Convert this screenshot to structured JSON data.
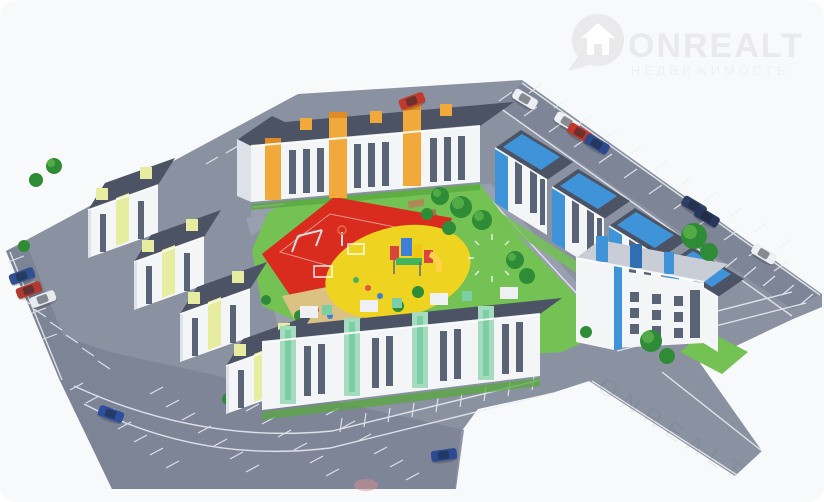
{
  "image": {
    "kind": "aerial-3d-render",
    "subject": "Residential quarter with courtyard playground, parking lots and landscaping"
  },
  "logo": {
    "brand": "ONREALT",
    "subtitle": "НЕДВИЖИМОСТЬ",
    "icon": "house-location-pin-icon",
    "color": "#eaeaec",
    "subtitle_color": "#f0f0f2"
  },
  "palette": {
    "page_bg": "#ffffff",
    "card_bg": "#f8f9fa",
    "ground": "#8a91a1",
    "parking": "#7a8295",
    "road_light": "#9aa1b0",
    "marking": "#eef0f4",
    "lawn": "#74c154",
    "lawn_dark": "#57a83e",
    "tree": "#2f8c36",
    "tree_light": "#5cb34c",
    "sport_red": "#d92c1e",
    "play_yellow": "#efd321",
    "sand": "#dcc184",
    "roof_dark": "#4c5365",
    "roof_light": "#c9ced6",
    "wall_white": "#f4f5f7",
    "wall_shade": "#dde1e8",
    "window": "#3f4b60",
    "accent_orange": "#f2a93b",
    "accent_orange_dark": "#e08c26",
    "accent_blue": "#3f93d8",
    "accent_blue_dark": "#2e6fb3",
    "accent_lime": "#e7eda0",
    "accent_mint": "#a5dcc0",
    "accent_mint_dark": "#7ccfa4"
  },
  "scene": {
    "buildings": [
      {
        "id": "north-building",
        "accent": "orange",
        "floors": 3
      },
      {
        "id": "east-building-row",
        "accent": "blue",
        "floors": 4,
        "blocks": 4
      },
      {
        "id": "east-corner-building",
        "accent": "blue",
        "floors": 3
      },
      {
        "id": "west-building-row",
        "accent": "lime",
        "floors": 3,
        "blocks": 4
      },
      {
        "id": "south-building",
        "accent": "mint",
        "floors": 3
      }
    ],
    "courtyard": {
      "features": [
        "sports-court",
        "playground",
        "sandbox",
        "lawn",
        "trees",
        "pergola",
        "paving-circle"
      ]
    },
    "parking_areas": [
      "top-right-street",
      "right-street",
      "bottom-left-lot",
      "left-street",
      "inner-courtyard"
    ],
    "cars": [
      {
        "color": "#eceef2"
      },
      {
        "color": "#f0f1f4"
      },
      {
        "color": "#c0392b"
      },
      {
        "color": "#2c4a8c"
      },
      {
        "color": "#c0392b"
      },
      {
        "color": "#2e3f66"
      },
      {
        "color": "#27365c"
      },
      {
        "color": "#eef0f3"
      },
      {
        "color": "#31508f"
      },
      {
        "color": "#b03a30"
      },
      {
        "color": "#e8eaee"
      },
      {
        "color": "#2d4f9e"
      },
      {
        "color": "#2b4a91"
      }
    ]
  }
}
